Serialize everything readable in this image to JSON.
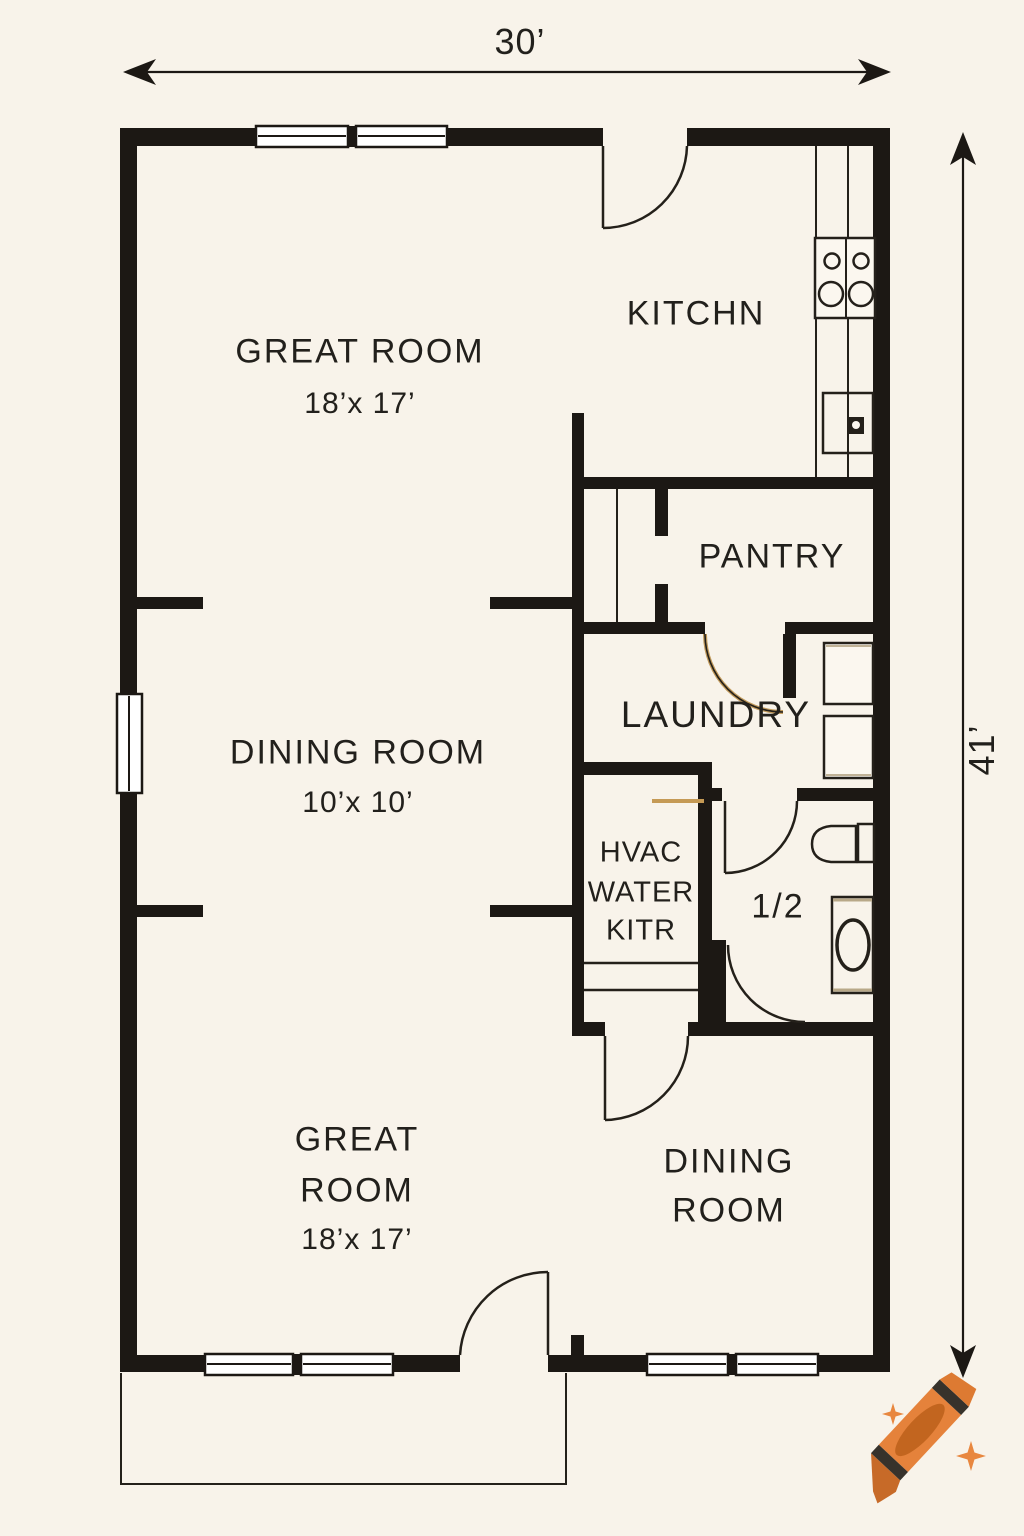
{
  "drawing_type": "residential floor plan",
  "dimensions": {
    "width_label": "30’",
    "height_label": "41’"
  },
  "rooms": {
    "great_room_top": {
      "name": "GREAT ROOM",
      "size": "18’x 17’"
    },
    "kitchen": {
      "name": "KITCHN"
    },
    "pantry": {
      "name": "PANTRY"
    },
    "laundry": {
      "name": "LAUNDRY"
    },
    "utility_closet": {
      "line1": "HVAC",
      "line2": "WATER",
      "line3": "KITR"
    },
    "half_bath": {
      "name": "1/2"
    },
    "dining_room_middle": {
      "name": "DINING ROOM",
      "size": "10’x 10’"
    },
    "great_room_bottom": {
      "line1": "GREAT",
      "line2": "ROOM",
      "size": "18’x 17’"
    },
    "dining_room_bottom": {
      "line1": "DINING",
      "line2": "ROOM"
    }
  },
  "icons": {
    "stove": "stove-icon",
    "sink": "sink-icon",
    "washer": "washer-icon",
    "dryer": "dryer-icon",
    "toilet": "toilet-icon",
    "vanity_sink": "vanity-sink-icon",
    "crayon": "crayon-icon",
    "sparkle": "sparkle-icon"
  },
  "colors": {
    "background": "#F8F3EA",
    "wall": "#1C1814",
    "line": "#24201A",
    "accent_tan": "#C59A55",
    "crayon_orange": "#E5823B",
    "crayon_dark_orange": "#C76A28",
    "crayon_band": "#37322B",
    "sparkle": "#E8873F"
  }
}
